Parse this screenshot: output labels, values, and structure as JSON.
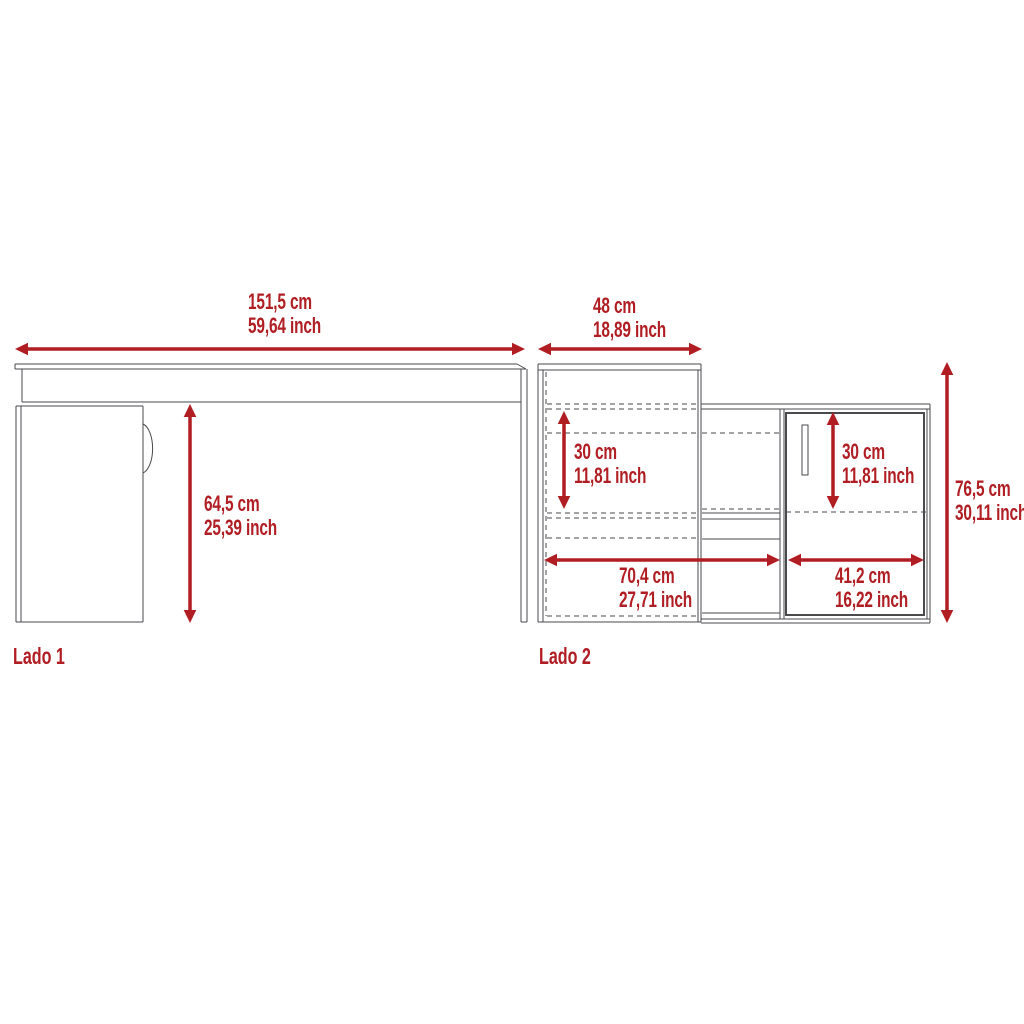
{
  "palette": {
    "dimension_color": "#B01E24",
    "outline_color": "#4A4A4D",
    "background": "#FFFFFF"
  },
  "side1": {
    "label": "Lado 1",
    "dims": {
      "width": {
        "cm": "151,5 cm",
        "inch": "59,64 inch"
      },
      "height": {
        "cm": "64,5 cm",
        "inch": "25,39 inch"
      }
    }
  },
  "side2": {
    "label": "Lado 2",
    "dims": {
      "top_width": {
        "cm": "48 cm",
        "inch": "18,89 inch"
      },
      "hutch_shelf_height": {
        "cm": "30 cm",
        "inch": "11,81 inch"
      },
      "cabinet_shelf_height": {
        "cm": "30 cm",
        "inch": "11,81 inch"
      },
      "open_section_width": {
        "cm": "70,4 cm",
        "inch": "27,71 inch"
      },
      "cabinet_width": {
        "cm": "41,2 cm",
        "inch": "16,22 inch"
      },
      "total_height": {
        "cm": "76,5 cm",
        "inch": "30,11 inch"
      }
    }
  }
}
